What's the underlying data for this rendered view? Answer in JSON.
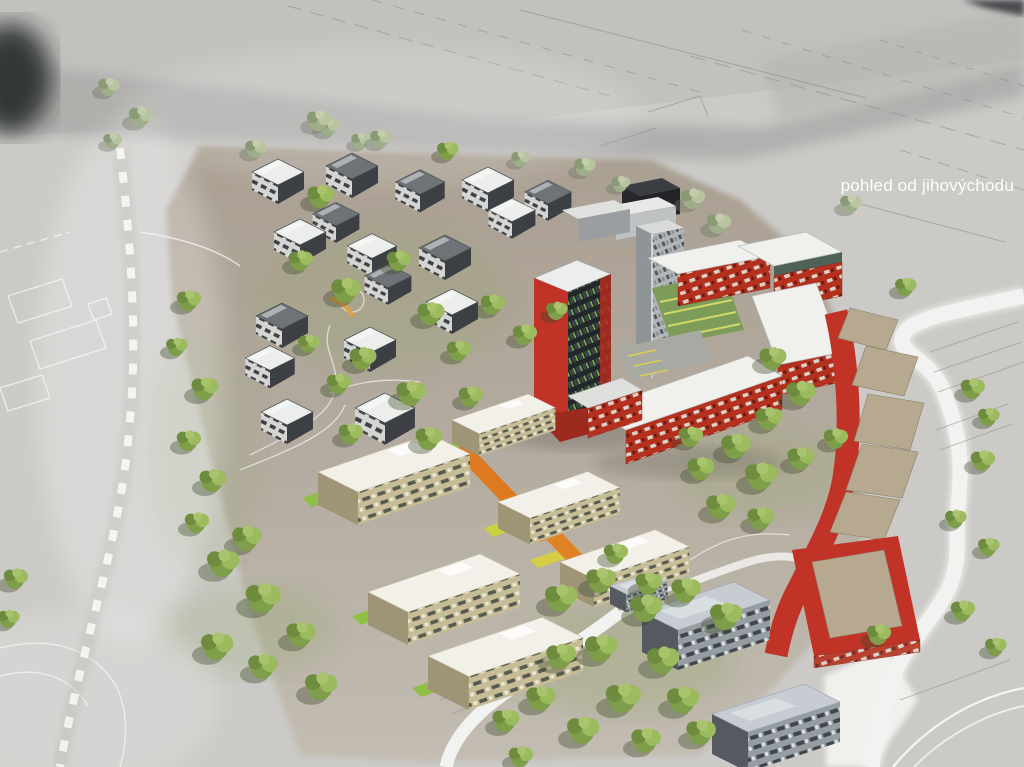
{
  "meta": {
    "type": "architectural-aerial-rendering",
    "description": "Aerial 3D visualization of a planned residential development with villa district, tower ensemble, red courtyard block, curved red terrace, beige apartment cluster and gray apartment blocks"
  },
  "caption": {
    "text": "pohled od jihovýchodu"
  },
  "colors": {
    "caption_color": "#ffffff",
    "ground": "#cbcac7",
    "ground_road": "#adacaa",
    "site_ground": "#a89d8f",
    "site_ground_light": "#c3bcb1",
    "road_white": "#f2f2f0",
    "accent_red": "#c13326",
    "red_dark": "#8d2418",
    "roof_white": "#f0f0ed",
    "roof_gray": "#6e7377",
    "villa_wall_dark": "#3c4044",
    "tower_gray": "#a9adb0",
    "beige_wall": "#c6bc96",
    "gray_wall": "#949ba0",
    "tree_green": "#7f9e4a",
    "tree_green_light": "#9cba5e",
    "tree_green_dark": "#6d8c3e",
    "lawn_green": "#8fc045",
    "lawn_yellow": "#c9d23e",
    "path_orange": "#dd7920"
  }
}
